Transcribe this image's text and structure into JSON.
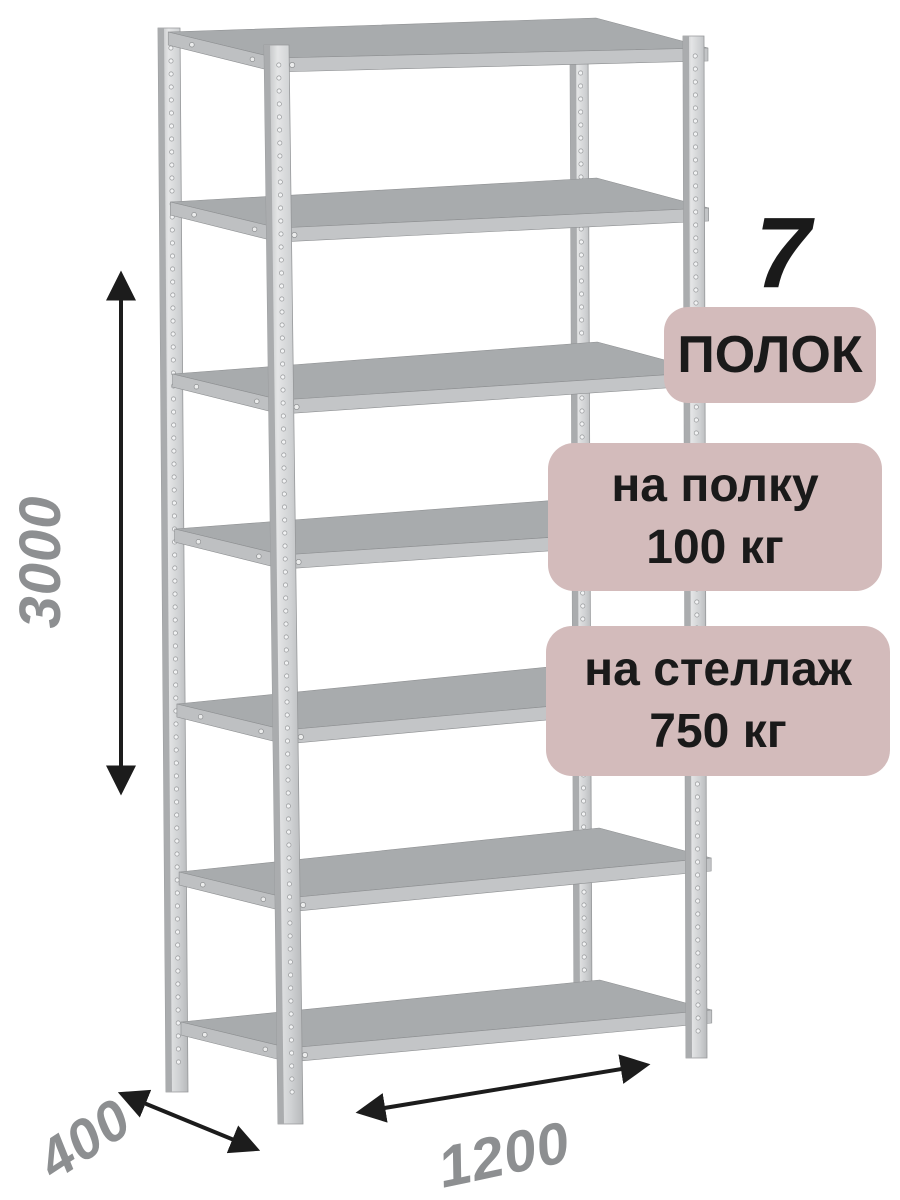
{
  "annotations": {
    "shelf_count_number": "7",
    "badge_shelves_text": "ПОЛОК",
    "badge_per_shelf_line1": "на полку",
    "badge_per_shelf_line2": "100 кг",
    "badge_per_rack_line1": "на стеллаж",
    "badge_per_rack_line2": "750 кг"
  },
  "dimensions": {
    "height_mm": "3000",
    "depth_mm": "400",
    "width_mm": "1200"
  },
  "rack": {
    "shelf_count": 7,
    "post_count": 4
  },
  "colors": {
    "badge_bg": "#d3bbbb",
    "annotation_text": "#1a1a1a",
    "dimension_text": "#8d8f91",
    "arrow": "#1c1c1c",
    "metal_light": "#e3e4e5",
    "metal_mid": "#c3c5c7",
    "metal_dark": "#aaacae",
    "shelf_top": "#a8abad"
  }
}
